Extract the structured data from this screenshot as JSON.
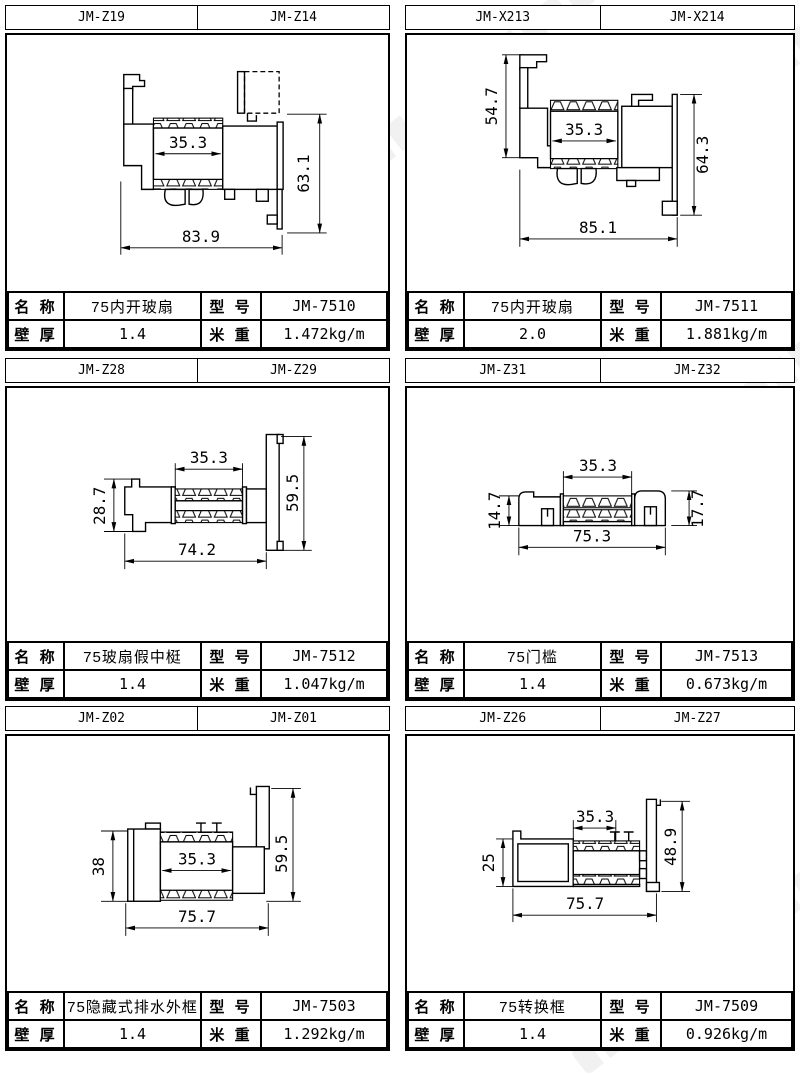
{
  "colors": {
    "background": "#ffffff",
    "line": "#000000",
    "watermark": "rgba(0,0,0,0.06)"
  },
  "labels": {
    "name": "名 称",
    "model": "型 号",
    "thickness": "壁 厚",
    "weight": "米 重"
  },
  "cells": [
    {
      "codes": [
        "JM-Z19",
        "JM-Z14"
      ],
      "name": "75内开玻扇",
      "model": "JM-7510",
      "thickness": "1.4",
      "weight": "1.472kg/m",
      "dims": {
        "inner": "35.3",
        "right": "63.1",
        "bottom": "83.9"
      }
    },
    {
      "codes": [
        "JM-X213",
        "JM-X214"
      ],
      "name": "75内开玻扇",
      "model": "JM-7511",
      "thickness": "2.0",
      "weight": "1.881kg/m",
      "dims": {
        "left": "54.7",
        "inner": "35.3",
        "right": "64.3",
        "bottom": "85.1"
      }
    },
    {
      "codes": [
        "JM-Z28",
        "JM-Z29"
      ],
      "name": "75玻扇假中梃",
      "model": "JM-7512",
      "thickness": "1.4",
      "weight": "1.047kg/m",
      "dims": {
        "top": "35.3",
        "left": "28.7",
        "right": "59.5",
        "bottom": "74.2"
      }
    },
    {
      "codes": [
        "JM-Z31",
        "JM-Z32"
      ],
      "name": "75门槛",
      "model": "JM-7513",
      "thickness": "1.4",
      "weight": "0.673kg/m",
      "dims": {
        "top": "35.3",
        "left": "14.7",
        "right": "17.7",
        "bottom": "75.3"
      }
    },
    {
      "codes": [
        "JM-Z02",
        "JM-Z01"
      ],
      "name": "75隐藏式排水外框",
      "model": "JM-7503",
      "thickness": "1.4",
      "weight": "1.292kg/m",
      "dims": {
        "left": "38",
        "inner": "35.3",
        "right": "59.5",
        "bottom": "75.7"
      }
    },
    {
      "codes": [
        "JM-Z26",
        "JM-Z27"
      ],
      "name": "75转换框",
      "model": "JM-7509",
      "thickness": "1.4",
      "weight": "0.926kg/m",
      "dims": {
        "top": "35.3",
        "left": "25",
        "right": "48.9",
        "bottom": "75.7"
      }
    }
  ]
}
